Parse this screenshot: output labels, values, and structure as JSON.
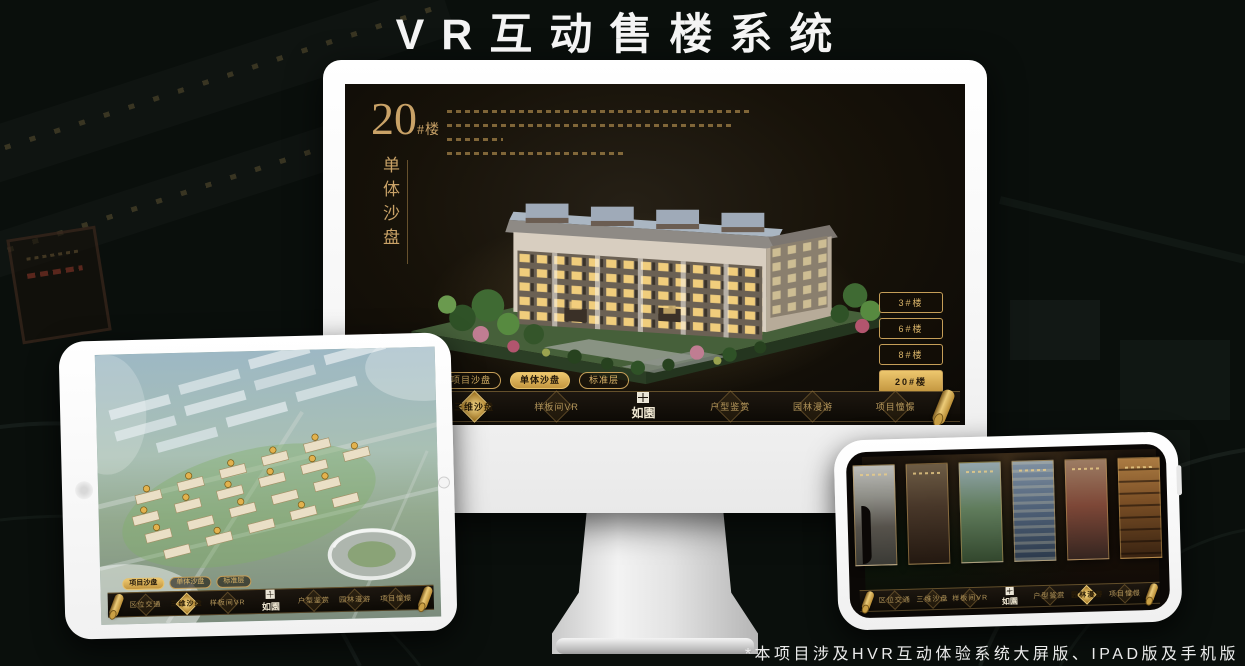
{
  "page": {
    "title": "VR互动售楼系统",
    "caption": "*本项目涉及HVR互动体验系统大屏版、IPAD版及手机版"
  },
  "colors": {
    "gold": "#c9a267",
    "gold_bright": "#edc76e",
    "screen_background": "#171209",
    "frame_white": "#ffffff"
  },
  "screen_ui": {
    "building_number": "20",
    "building_unit": "#楼",
    "screen_title_vertical": "单体沙盘",
    "floor_buttons": [
      {
        "label": "3#楼",
        "active": false
      },
      {
        "label": "6#楼",
        "active": false
      },
      {
        "label": "8#楼",
        "active": false
      },
      {
        "label": "20#楼",
        "active": true
      }
    ],
    "monitor_tabs": [
      {
        "label": "项目沙盘",
        "active": false
      },
      {
        "label": "单体沙盘",
        "active": true
      },
      {
        "label": "标准层",
        "active": false
      }
    ],
    "tablet_tabs": [
      {
        "label": "项目沙盘",
        "active": true
      },
      {
        "label": "单体沙盘",
        "active": false
      },
      {
        "label": "标准层",
        "active": false
      }
    ],
    "nav": {
      "logo": "如園",
      "items": [
        "区位交通",
        "三维沙盘",
        "样板间VR",
        "户型鉴赏",
        "园林漫游",
        "项目憧憬"
      ],
      "monitor_active": "三维沙盘",
      "tablet_active": "三维沙盘",
      "phone_active": "园林漫游"
    }
  }
}
